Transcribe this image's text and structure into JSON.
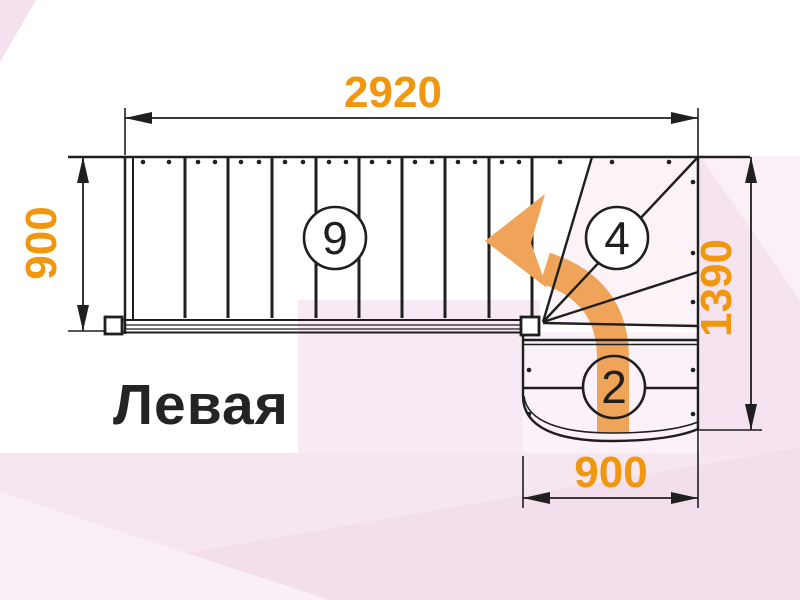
{
  "diagram": {
    "type": "stair-plan-top-view",
    "variant_label": "Левая",
    "dimensions": {
      "top_width": "2920",
      "flight_width": "900",
      "right_height": "1390",
      "bottom_width": "900"
    },
    "step_counts": {
      "straight_flight": "9",
      "winder_steps": "4",
      "bottom_flight": "2"
    },
    "colors": {
      "dimension_text": "#F1970D",
      "turn_arrow": "#F0A45A",
      "linework": "#1F1F1F"
    },
    "icons": {
      "turn_arrow": "turn-left-curved-arrow-icon"
    }
  }
}
